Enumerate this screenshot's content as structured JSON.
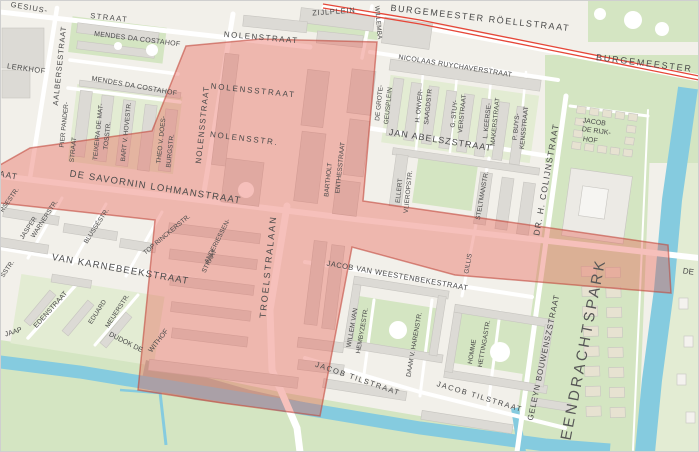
{
  "map": {
    "colors": {
      "land": "#f2f0ea",
      "road": "#ffffff",
      "water": "#85cbdf",
      "park": "#d4e5c2",
      "park_light": "#e3ecd3",
      "building": "#dcdad5",
      "building_outline": "#c7c5c0",
      "building_beige": "#e7e2d1",
      "overlay_fill": "#e85a4c",
      "overlay_stroke": "#c2473c",
      "tram": "#e64638",
      "label": "#4a4a4a",
      "park_label": "#565656",
      "frame": "#cfcfcf"
    },
    "labels": [
      {
        "t": "GESIUS-",
        "x": 29,
        "y": 10,
        "r": 10,
        "s": 7.5,
        "ls": 1
      },
      {
        "t": "STRAAT",
        "x": 109,
        "y": 20,
        "r": 6,
        "s": 7.5,
        "ls": 1.5
      },
      {
        "t": "LERKHOF",
        "x": 26,
        "y": 71,
        "r": 8,
        "s": 7.5,
        "ls": 0.5
      },
      {
        "t": "MENDES DA COSTAHOF",
        "x": 137,
        "y": 41,
        "r": 7,
        "s": 7,
        "ls": 0.3
      },
      {
        "t": "MENDES DA COSTAHOF",
        "x": 134,
        "y": 88,
        "r": 10,
        "s": 7,
        "ls": 0.3
      },
      {
        "t": "AALBERSESTRAAT",
        "x": 62,
        "y": 66,
        "r": -84,
        "s": 7.5,
        "ls": 0.8
      },
      {
        "t": "PIER PANDER-",
        "x": 66,
        "y": 125,
        "r": -84,
        "s": 6.5
      },
      {
        "t": "STRAAT",
        "x": 75,
        "y": 150,
        "r": -84,
        "s": 6.5
      },
      {
        "t": "TEIXEIRA DE MAT-",
        "x": 100,
        "y": 132,
        "r": -84,
        "s": 6.5
      },
      {
        "t": "TOSSTR.",
        "x": 109,
        "y": 136,
        "r": -84,
        "s": 6.5
      },
      {
        "t": "BART V. HOVESTR.",
        "x": 128,
        "y": 132,
        "r": -84,
        "s": 6.5
      },
      {
        "t": "THEO V. DOES-",
        "x": 163,
        "y": 140,
        "r": -84,
        "s": 6.5
      },
      {
        "t": "BURGSTR.",
        "x": 172,
        "y": 151,
        "r": -84,
        "s": 6.5
      },
      {
        "t": "NOLENSSTRAAT",
        "x": 205,
        "y": 125,
        "r": -84,
        "s": 8,
        "ls": 1.2
      },
      {
        "t": "NOLENSTRAAT",
        "x": 261,
        "y": 40,
        "r": 5,
        "s": 8,
        "ls": 1.5
      },
      {
        "t": "NOLENSSTRAAT",
        "x": 253,
        "y": 93,
        "r": 6,
        "s": 8,
        "ls": 1.8
      },
      {
        "t": "NOLENSSTR.",
        "x": 244,
        "y": 141,
        "r": 7,
        "s": 8,
        "ls": 1.8
      },
      {
        "t": "ZIJLPLEIN",
        "x": 334,
        "y": 14,
        "r": -4,
        "s": 7.5,
        "ls": 0.8
      },
      {
        "t": "WILLEMBA",
        "x": 375,
        "y": 6,
        "r": 85,
        "s": 6.5,
        "a": "start"
      },
      {
        "t": "BURGEMEESTER RÖELLSTRAAT",
        "x": 480,
        "y": 21,
        "r": 6.5,
        "s": 9,
        "ls": 1.6
      },
      {
        "t": "BURGEMEESTER",
        "x": 644,
        "y": 66,
        "r": 7,
        "s": 9,
        "ls": 1.8
      },
      {
        "t": "NICOLAAS RUYCHAVERSTRAAT",
        "x": 455,
        "y": 68,
        "r": 9,
        "s": 7,
        "ls": 0.3
      },
      {
        "t": "DE GROTE-",
        "x": 381,
        "y": 103,
        "r": -84,
        "s": 6.5
      },
      {
        "t": "GEUSPLEIN",
        "x": 390,
        "y": 106,
        "r": -84,
        "s": 6.5
      },
      {
        "t": "H. ONVER-",
        "x": 421,
        "y": 106,
        "r": -84,
        "s": 6.5
      },
      {
        "t": "SAAGDSTR",
        "x": 430,
        "y": 107,
        "r": -84,
        "s": 6.5
      },
      {
        "t": "G. STUY-",
        "x": 456,
        "y": 114,
        "r": -84,
        "s": 6.5
      },
      {
        "t": "VERSTRAAT",
        "x": 464,
        "y": 114,
        "r": -84,
        "s": 6.5
      },
      {
        "t": "L. KEERSE-",
        "x": 489,
        "y": 121,
        "r": -84,
        "s": 6.5
      },
      {
        "t": "MAKERSTRAAT",
        "x": 497,
        "y": 122,
        "r": -84,
        "s": 6.5
      },
      {
        "t": "P. BUYS-",
        "x": 518,
        "y": 127,
        "r": -84,
        "s": 6.5
      },
      {
        "t": "KENSSTRAAT",
        "x": 526,
        "y": 128,
        "r": -84,
        "s": 6.5
      },
      {
        "t": "JAN ABELSZSTRAAT",
        "x": 440,
        "y": 143,
        "r": 9,
        "s": 9,
        "ls": 1
      },
      {
        "t": "DR. H. COLIJNSTRAAT",
        "x": 549,
        "y": 180,
        "r": -80,
        "s": 8.5,
        "ls": 1.2
      },
      {
        "t": "JACOB",
        "x": 594,
        "y": 124,
        "r": 8,
        "s": 7
      },
      {
        "t": "DE RIJK-",
        "x": 596,
        "y": 133,
        "r": 8,
        "s": 7
      },
      {
        "t": "HOF",
        "x": 590,
        "y": 142,
        "r": 8,
        "s": 7
      },
      {
        "t": "DE SAVORNIN LOHMANSTRAAT",
        "x": 155,
        "y": 190,
        "r": 9,
        "s": 9.5,
        "ls": 1.2
      },
      {
        "t": "JASPER",
        "x": 30,
        "y": 229,
        "r": -57,
        "s": 6.5
      },
      {
        "t": "WARNERSTR.",
        "x": 46,
        "y": 220,
        "r": -57,
        "s": 6.5
      },
      {
        "t": "BLUSSÉSTR.",
        "x": 98,
        "y": 227,
        "r": -57,
        "s": 6.5
      },
      {
        "t": "TOP RINCKERSTR.",
        "x": 168,
        "y": 236,
        "r": -40,
        "s": 6.5
      },
      {
        "t": "VAN KARNEBEEKSTRAAT",
        "x": 120,
        "y": 272,
        "r": 10,
        "s": 9.5,
        "ls": 1.2
      },
      {
        "t": "ANDERIESSEN-",
        "x": 219,
        "y": 242,
        "r": -63,
        "s": 6.5
      },
      {
        "t": "STRAAT",
        "x": 211,
        "y": 262,
        "r": -63,
        "s": 6.5
      },
      {
        "t": "TROELSTRALAAN",
        "x": 271,
        "y": 267,
        "r": -84,
        "s": 9,
        "ls": 2
      },
      {
        "t": "BARTHOLT",
        "x": 330,
        "y": 180,
        "r": -84,
        "s": 6.5
      },
      {
        "t": "ENTHESSTRAAT",
        "x": 342,
        "y": 168,
        "r": -84,
        "s": 6.5
      },
      {
        "t": "ELLERT",
        "x": 401,
        "y": 191,
        "r": -84,
        "s": 6.5
      },
      {
        "t": "VLIEROPSTR.",
        "x": 410,
        "y": 192,
        "r": -84,
        "s": 6.5
      },
      {
        "t": "STELTMANSTR.",
        "x": 484,
        "y": 196,
        "r": -80,
        "s": 6.5
      },
      {
        "t": "GILLIS",
        "x": 470,
        "y": 264,
        "r": -80,
        "s": 6.5
      },
      {
        "t": "JACOB VAN WEESTENBEKESTRAAT",
        "x": 397,
        "y": 278,
        "r": 10,
        "s": 7.5,
        "ls": 0.5
      },
      {
        "t": "WILLEM VAN",
        "x": 354,
        "y": 328,
        "r": -80,
        "s": 6.5
      },
      {
        "t": "HEMBYZESTR.",
        "x": 364,
        "y": 331,
        "r": -80,
        "s": 6.5
      },
      {
        "t": "DAAM V. HARENSTR.",
        "x": 416,
        "y": 345,
        "r": -80,
        "s": 6.5
      },
      {
        "t": "HOMME",
        "x": 474,
        "y": 352,
        "r": -80,
        "s": 6.5
      },
      {
        "t": "HETTINGASTR.",
        "x": 486,
        "y": 344,
        "r": -80,
        "s": 6.5
      },
      {
        "t": "JACOB TILSTRAAT",
        "x": 357,
        "y": 381,
        "r": 19,
        "s": 7.5,
        "ls": 1.5
      },
      {
        "t": "JACOB TILSTRAAT",
        "x": 479,
        "y": 399,
        "r": 17,
        "s": 7.5,
        "ls": 1.5
      },
      {
        "t": "GELEYN BOUWENSZSTRAAT",
        "x": 546,
        "y": 358,
        "r": -78,
        "s": 8,
        "ls": 0.8
      },
      {
        "t": "EENDRACHTSPARK",
        "x": 588,
        "y": 350,
        "r": -79,
        "s": 15,
        "ls": 3,
        "c": "#565656"
      },
      {
        "t": "EDENSTRAAT",
        "x": 52,
        "y": 311,
        "r": -48,
        "s": 7
      },
      {
        "t": "EDUARD",
        "x": 99,
        "y": 313,
        "r": -57,
        "s": 6.5
      },
      {
        "t": "MEIJERSTR.",
        "x": 119,
        "y": 312,
        "r": -57,
        "s": 6.5
      },
      {
        "t": "DUDOK DE",
        "x": 125,
        "y": 344,
        "r": 27,
        "s": 7
      },
      {
        "t": "WITHOF",
        "x": 160,
        "y": 342,
        "r": -52,
        "s": 7
      },
      {
        "t": "JAAP",
        "x": 14,
        "y": 334,
        "r": -17,
        "s": 7
      },
      {
        "t": "AAT",
        "x": 8,
        "y": 178,
        "r": 10,
        "s": 8.5,
        "ls": 1
      },
      {
        "t": "RSESTR.",
        "x": 11,
        "y": 201,
        "r": -55,
        "s": 6.5
      },
      {
        "t": "SSTR.",
        "x": 9,
        "y": 270,
        "r": -55,
        "s": 6.5
      },
      {
        "t": "DE",
        "x": 688,
        "y": 274,
        "r": 8,
        "s": 8
      }
    ]
  }
}
